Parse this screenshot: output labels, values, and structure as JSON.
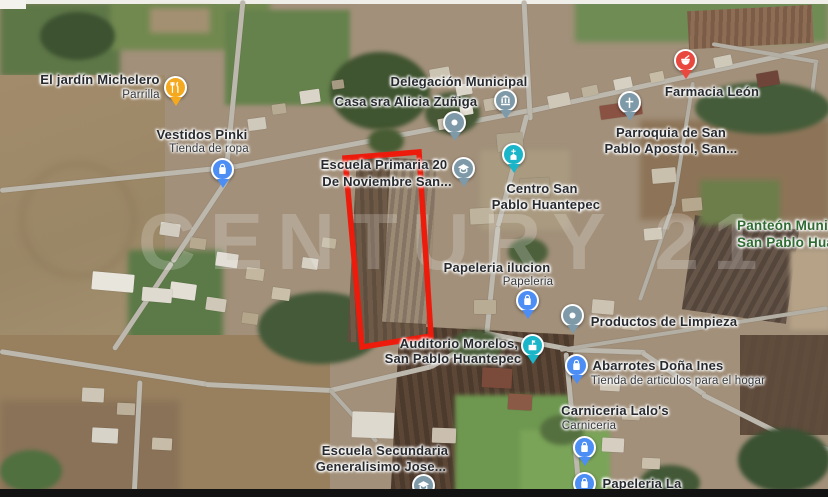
{
  "watermark": "CENTURY 21",
  "colors": {
    "boundary_red": "#ED1B0C",
    "pin_blue": "#4D8EF5",
    "pin_gray": "#7E99A8",
    "pin_teal": "#1AB5C9",
    "pin_orange": "#F4A91F",
    "pin_red": "#E9483F",
    "label_dark": "#26292E",
    "label_green": "#2F6B33"
  },
  "markers": [
    {
      "name": "el-jardin-michelero",
      "lines": [
        "El jardín Michelero"
      ],
      "sub": "Parrilla",
      "icon": "restaurant-pin"
    },
    {
      "name": "vestidos-pinki",
      "lines": [
        "Vestidos Pinki"
      ],
      "sub": "Tienda de ropa",
      "icon": "shopping-pin"
    },
    {
      "name": "delegacion-municipal",
      "lines": [
        "Delegación Municipal"
      ],
      "icon": "government-pin"
    },
    {
      "name": "casa-sra-alicia-zuniga",
      "lines": [
        "Casa sra Alicia Zuñiga"
      ],
      "icon": "dot-pin"
    },
    {
      "name": "escuela-primaria",
      "lines": [
        "Escuela Primaria 20",
        "De Noviembre San..."
      ],
      "icon": "school-pin"
    },
    {
      "name": "centro-san-pablo",
      "lines": [
        "Centro San",
        "Pablo Huantepec"
      ],
      "icon": "church-pin"
    },
    {
      "name": "farmacia-leon",
      "lines": [
        "Farmacia León"
      ],
      "icon": "pharmacy-pin"
    },
    {
      "name": "parroquia-san-pablo",
      "lines": [
        "Parroquia de San",
        "Pablo Apostol, San..."
      ],
      "icon": "cross-pin"
    },
    {
      "name": "panteon-municipal",
      "lines": [
        "Panteón Muni",
        "San Pablo Hua"
      ],
      "icon": "none"
    },
    {
      "name": "papeleria-ilucion",
      "lines": [
        "Papeleria ilucion"
      ],
      "sub": "Papeleria",
      "icon": "shopping-pin"
    },
    {
      "name": "productos-de-limpieza",
      "lines": [
        "Productos de Limpieza"
      ],
      "icon": "dot-pin"
    },
    {
      "name": "auditorio-morelos",
      "lines": [
        "Auditorio Morelos,",
        "San Pablo Huantepec"
      ],
      "icon": "auditorium-pin"
    },
    {
      "name": "abarrotes-dona-ines",
      "lines": [
        "Abarrotes Doña Ines"
      ],
      "sub": "Tienda de articulos para el hogar",
      "icon": "shopping-pin"
    },
    {
      "name": "carniceria-lalos",
      "lines": [
        "Carniceria Lalo's"
      ],
      "sub": "Carniceria",
      "icon": "shopping-pin"
    },
    {
      "name": "papeleria-la",
      "lines": [
        "Papeleria La"
      ],
      "icon": "shopping-pin"
    },
    {
      "name": "escuela-secundaria",
      "lines": [
        "Escuela Secundaria",
        "Generalisimo Jose..."
      ],
      "icon": "school-pin"
    }
  ]
}
